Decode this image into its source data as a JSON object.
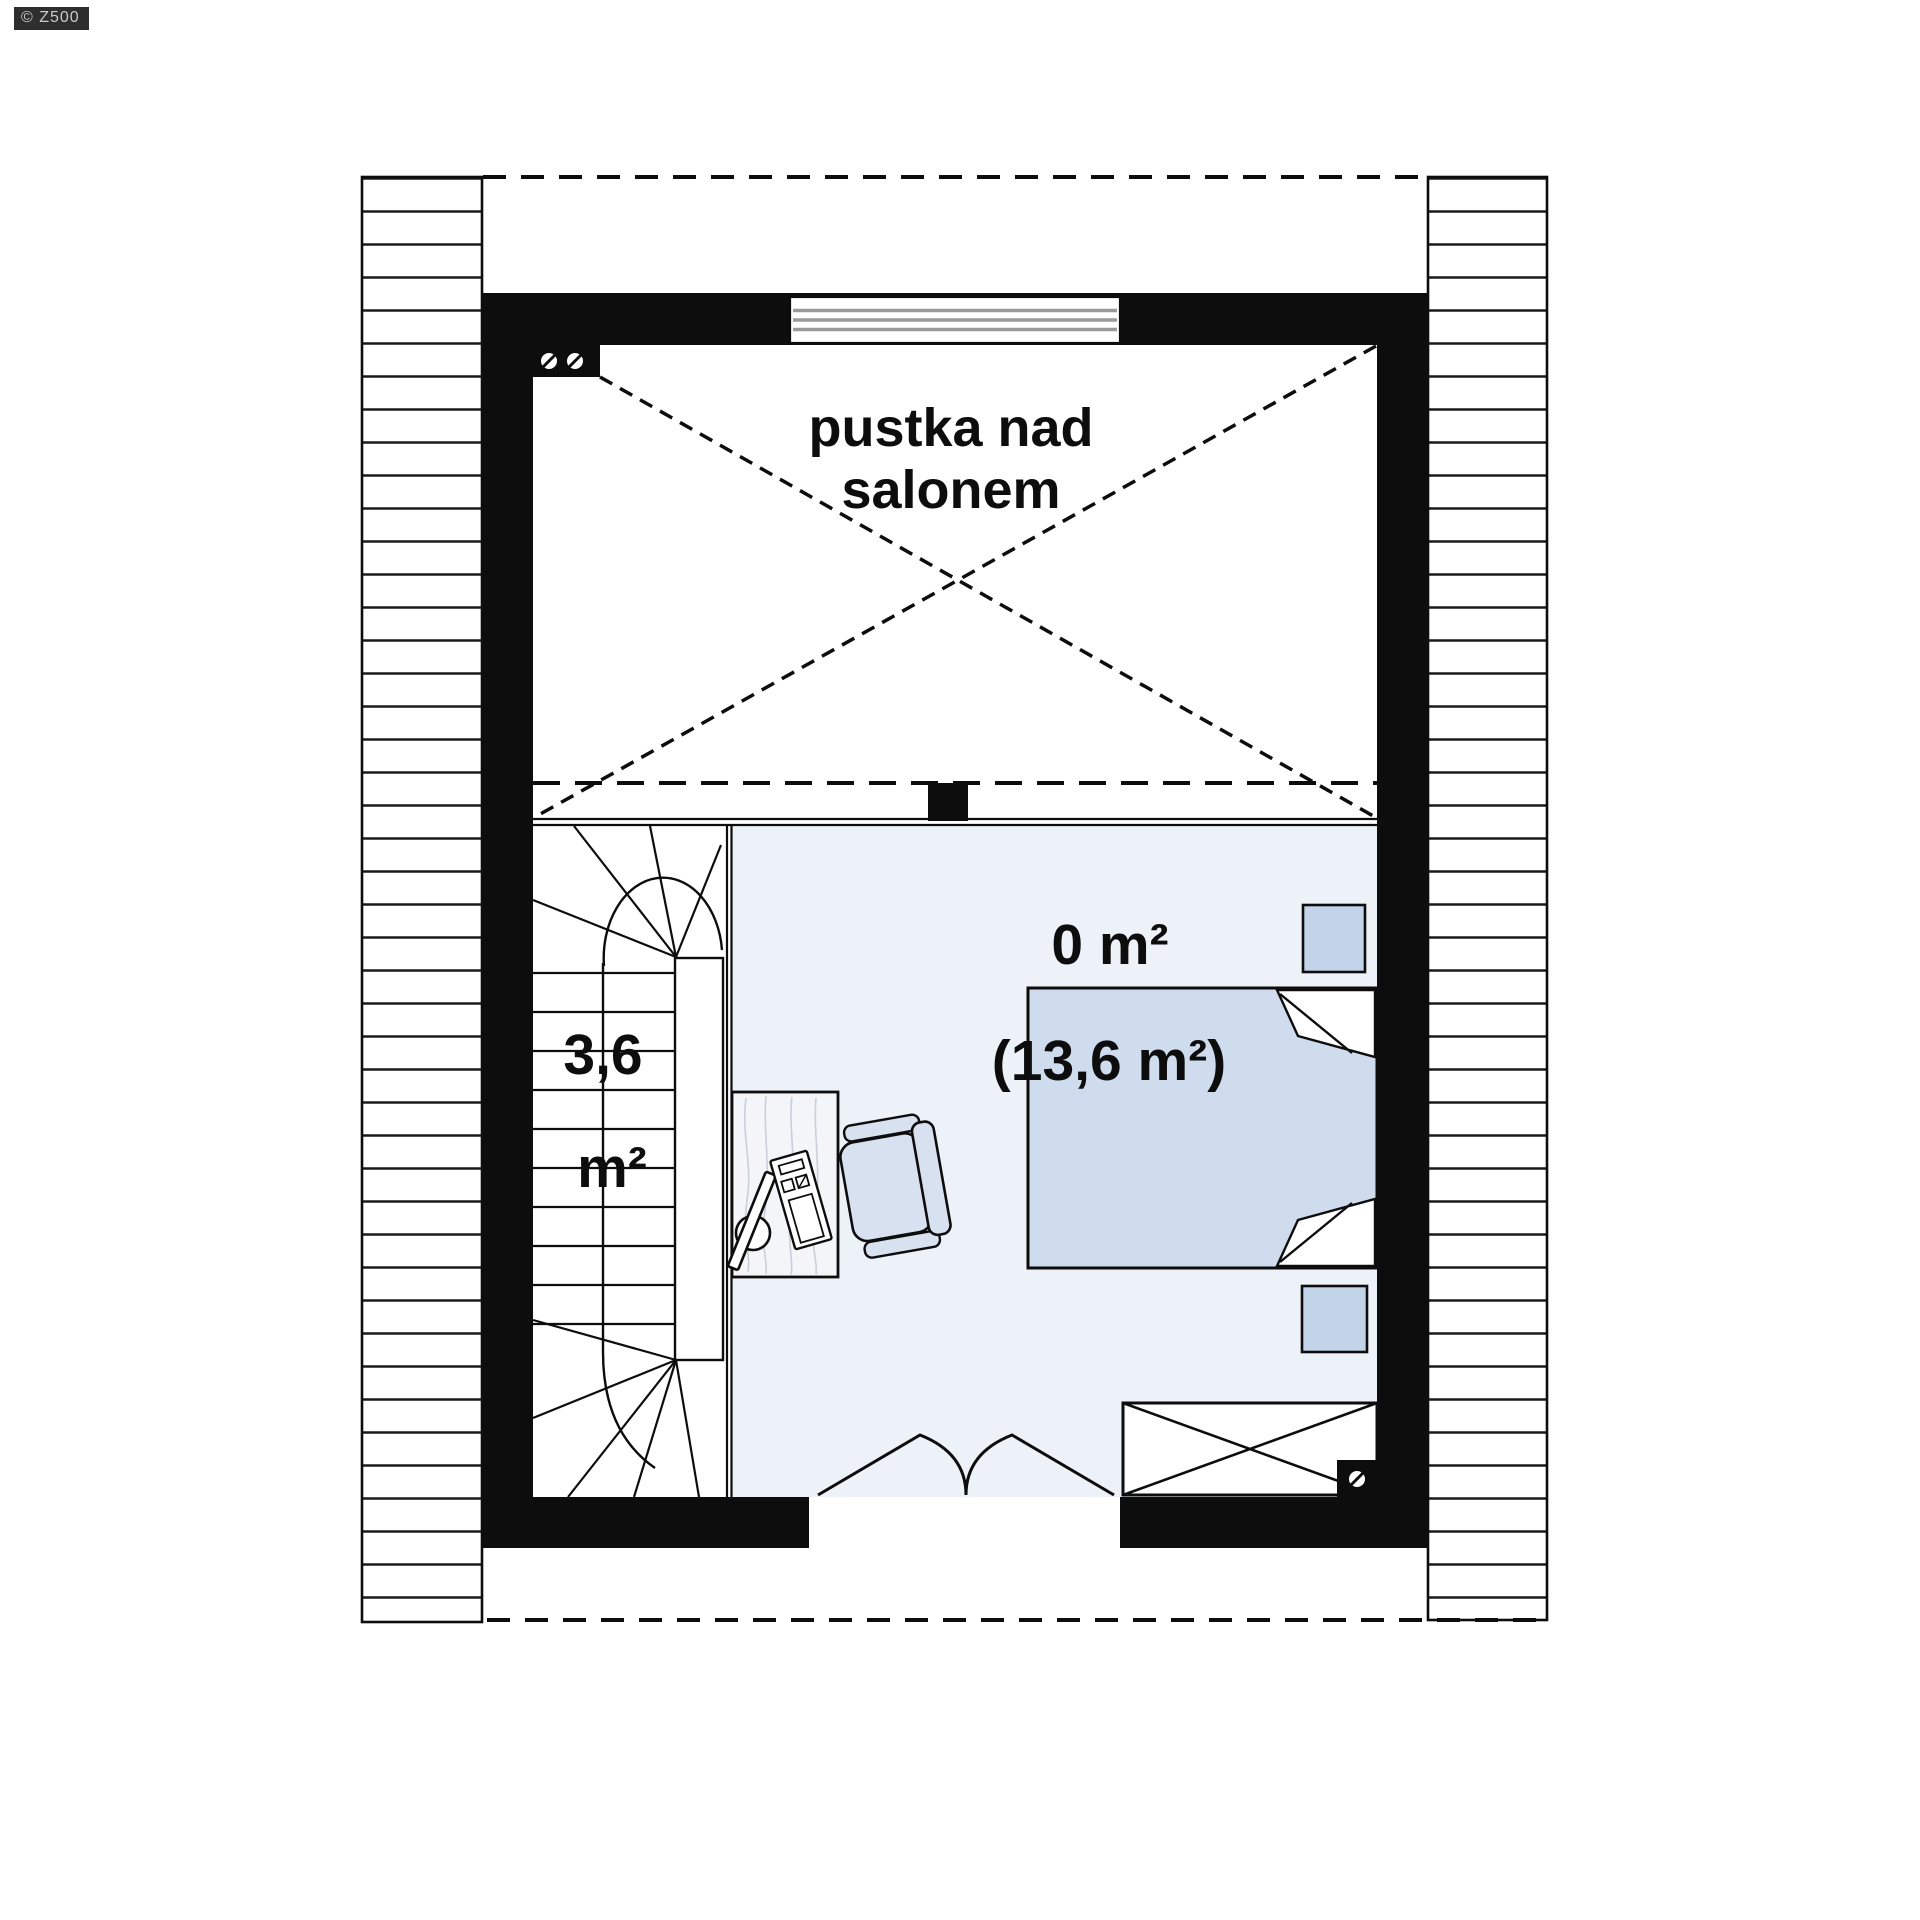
{
  "watermark": {
    "text": "© Z500"
  },
  "plan": {
    "type": "floor-plan-attic-storey",
    "labels": {
      "void_line1": "pustka nad",
      "void_line2": "salonem",
      "room_area": "0 m²",
      "room_area_alt": "(13,6 m²)",
      "stairs_area_value": "3,6",
      "stairs_area_unit": "m²"
    },
    "colors": {
      "ink": "#0d0d0d",
      "floor": "#edf1f8",
      "bed": "#cfdcee",
      "nightstand": "#c2d3ea",
      "chair": "#d7e1f0",
      "desk": "#f3f5f9",
      "grain": "#c9cfd9",
      "window_line": "#9a9a9a",
      "watermark_bg": "#2e2e2e",
      "watermark_fg": "#c9c9c9"
    }
  }
}
